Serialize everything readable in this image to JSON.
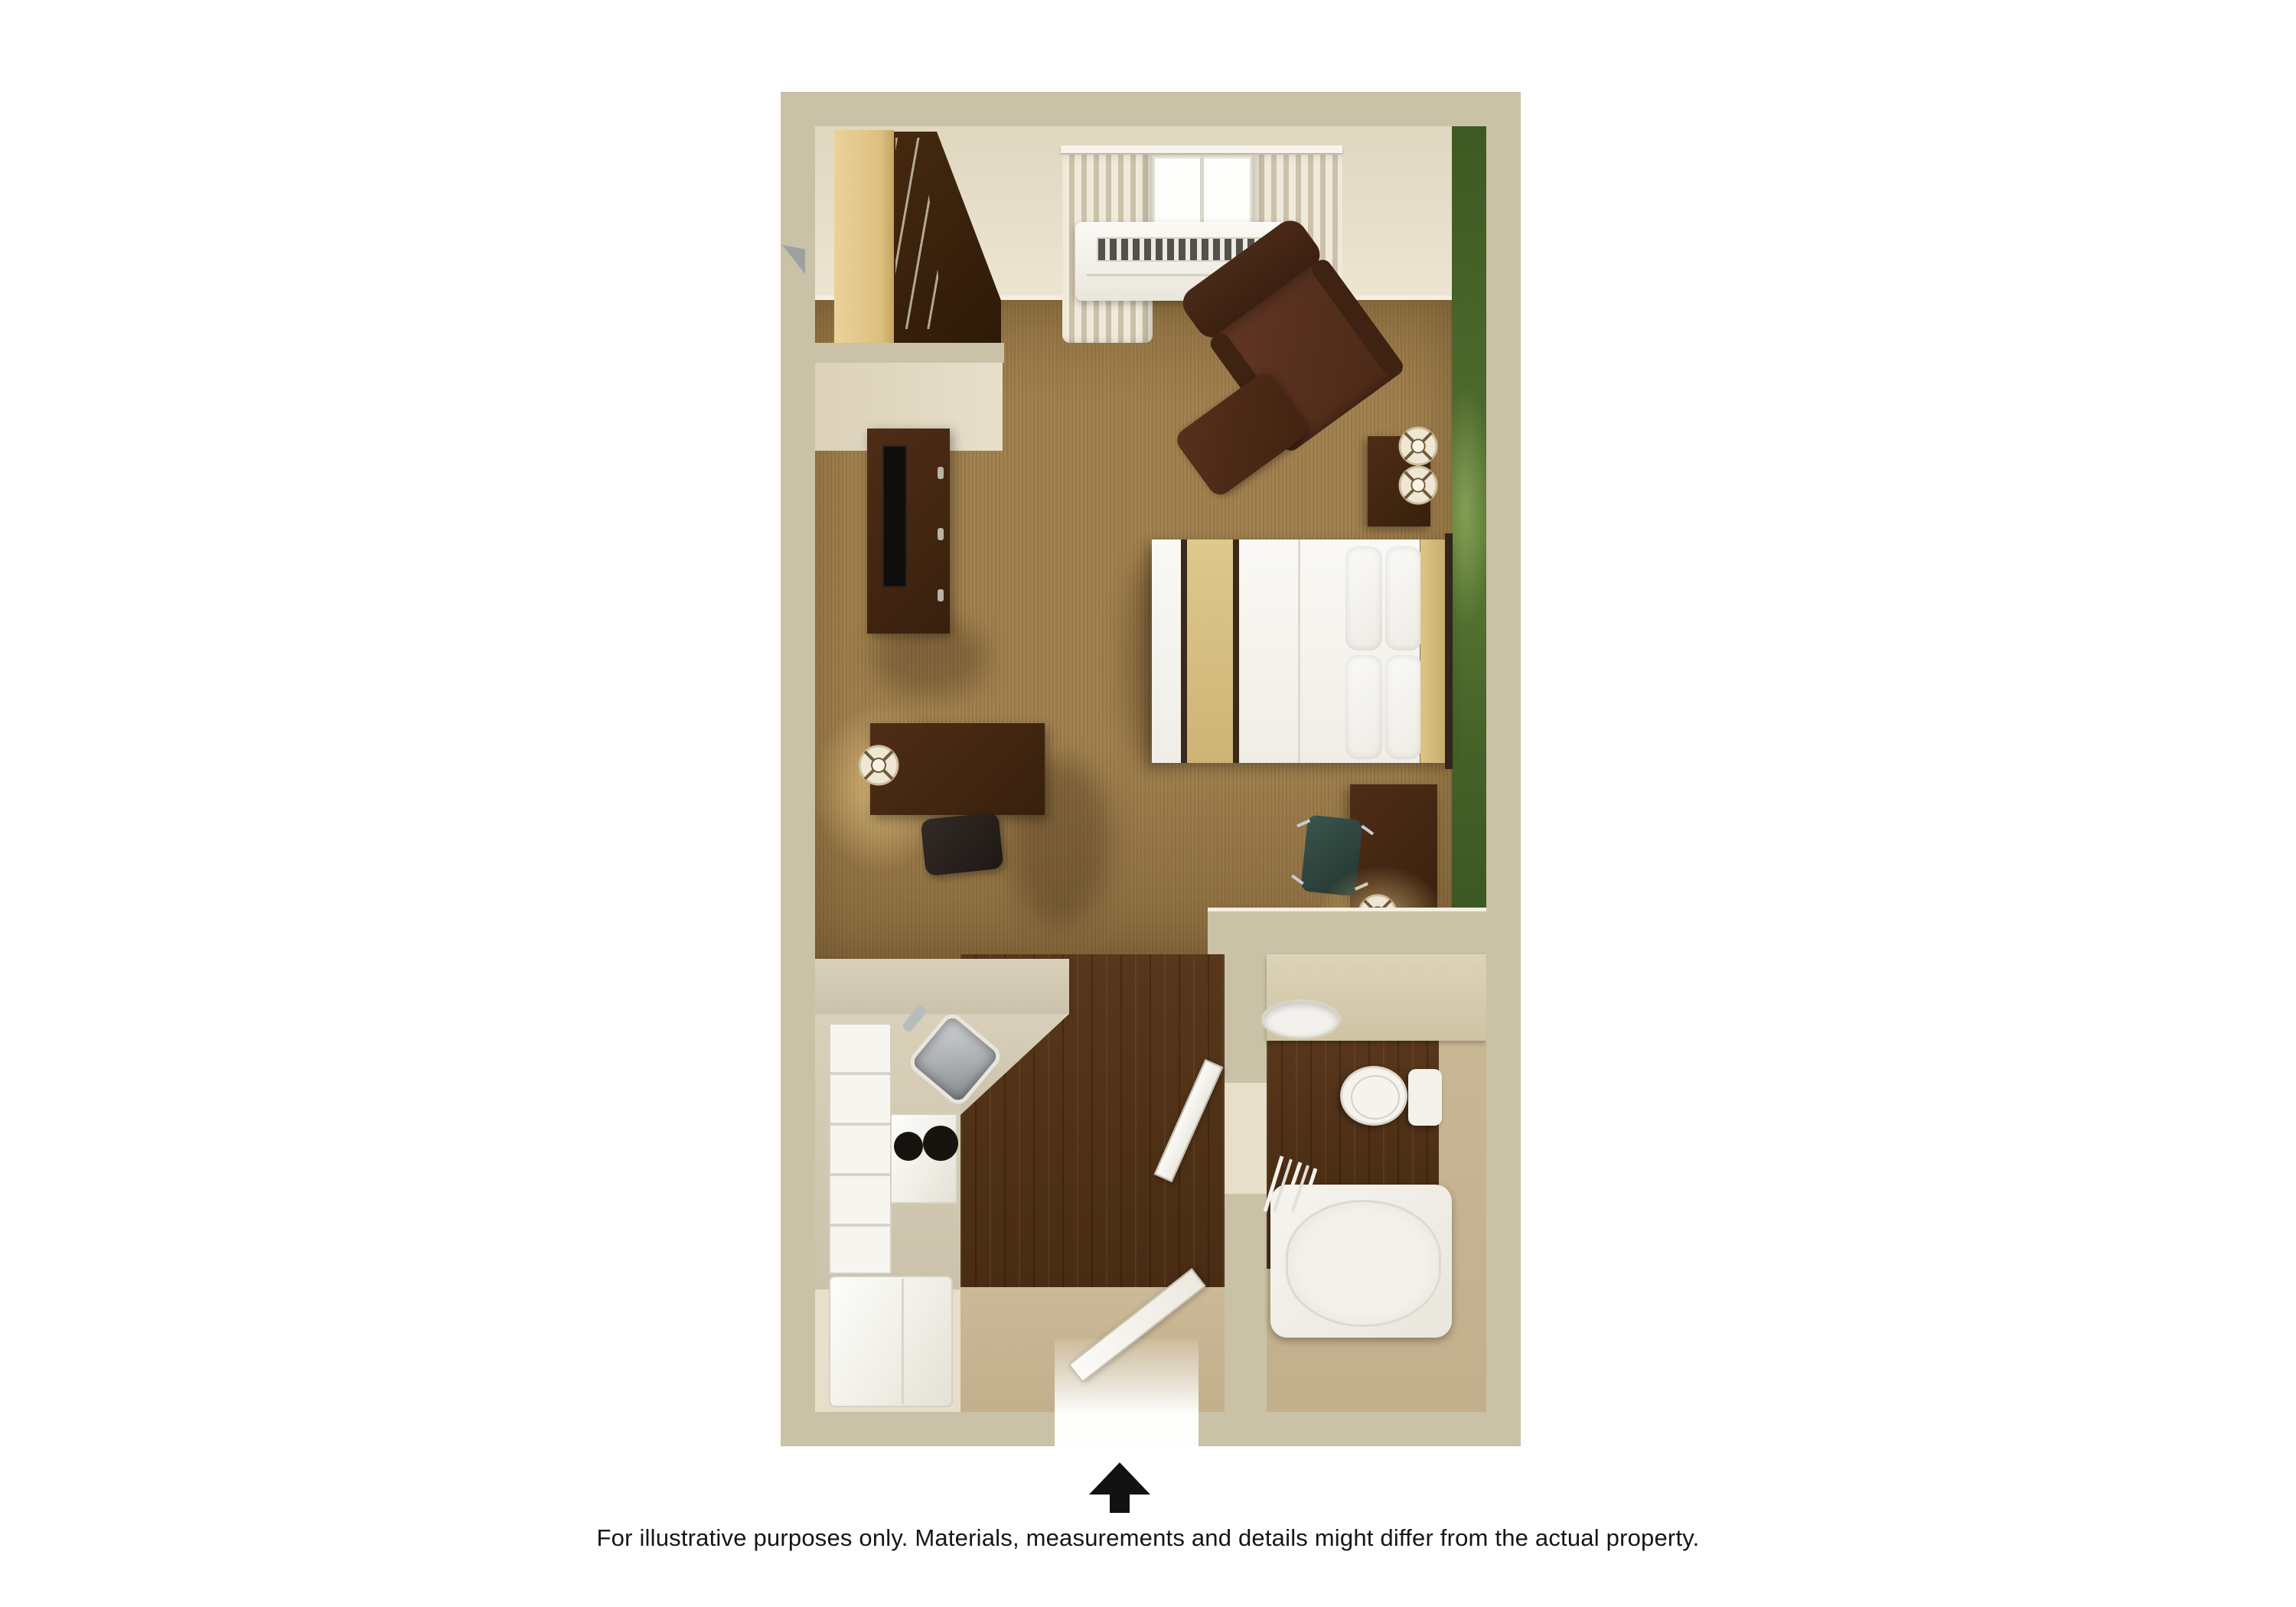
{
  "caption": {
    "text": "For illustrative purposes only.  Materials, measurements and details might differ from the actual property."
  },
  "north_arrow": {
    "label": "north-arrow",
    "direction": "up",
    "color": "#121212"
  },
  "floorplan": {
    "type": "3d-studio-suite-floor-plan",
    "rooms": [
      {
        "name": "bedroom-living-area",
        "floor": "brown-carpet",
        "features": [
          "window-with-curtains",
          "ptac-air-conditioner",
          "green-accent-wall",
          "closet-with-hangers",
          "tv-dresser",
          "flat-tv",
          "work-desk",
          "desk-lamp",
          "office-chair",
          "queen-bed",
          "pillows",
          "headboard",
          "nightstand",
          "two-table-lamps",
          "recliner-armchair",
          "ottoman",
          "console-table",
          "task-chair",
          "console-lamp"
        ]
      },
      {
        "name": "kitchen",
        "floor": "dark-wood",
        "features": [
          "l-shaped-counter",
          "stainless-sink",
          "faucet",
          "two-burner-stove",
          "cabinet-drawers",
          "refrigerator",
          "entry-door",
          "entry-floor-tan"
        ]
      },
      {
        "name": "bathroom",
        "floor": "dark-wood-and-tan",
        "features": [
          "vanity-counter",
          "vanity-sink",
          "toilet",
          "bathtub",
          "shower-curtain",
          "bathroom-door"
        ]
      }
    ]
  },
  "palette": {
    "wall_top": "#C9C2A6",
    "interior_wall": "#E7DFCA",
    "accent_wall_green": "#4C682C",
    "carpet": "#9F7E4B",
    "dark_wood_floor": "#4C2F15",
    "tan_floor": "#C7B691",
    "dark_furniture": "#42260F",
    "armchair": "#53301E",
    "bed_linen": "#F6F4EF",
    "bed_accent_khaki": "#D9C183",
    "counter": "#CFC7B1",
    "appliance_white": "#F4F2EC",
    "stainless": "#A8ACB0",
    "teal_chair": "#2E4540",
    "caption_text": "#161616"
  }
}
